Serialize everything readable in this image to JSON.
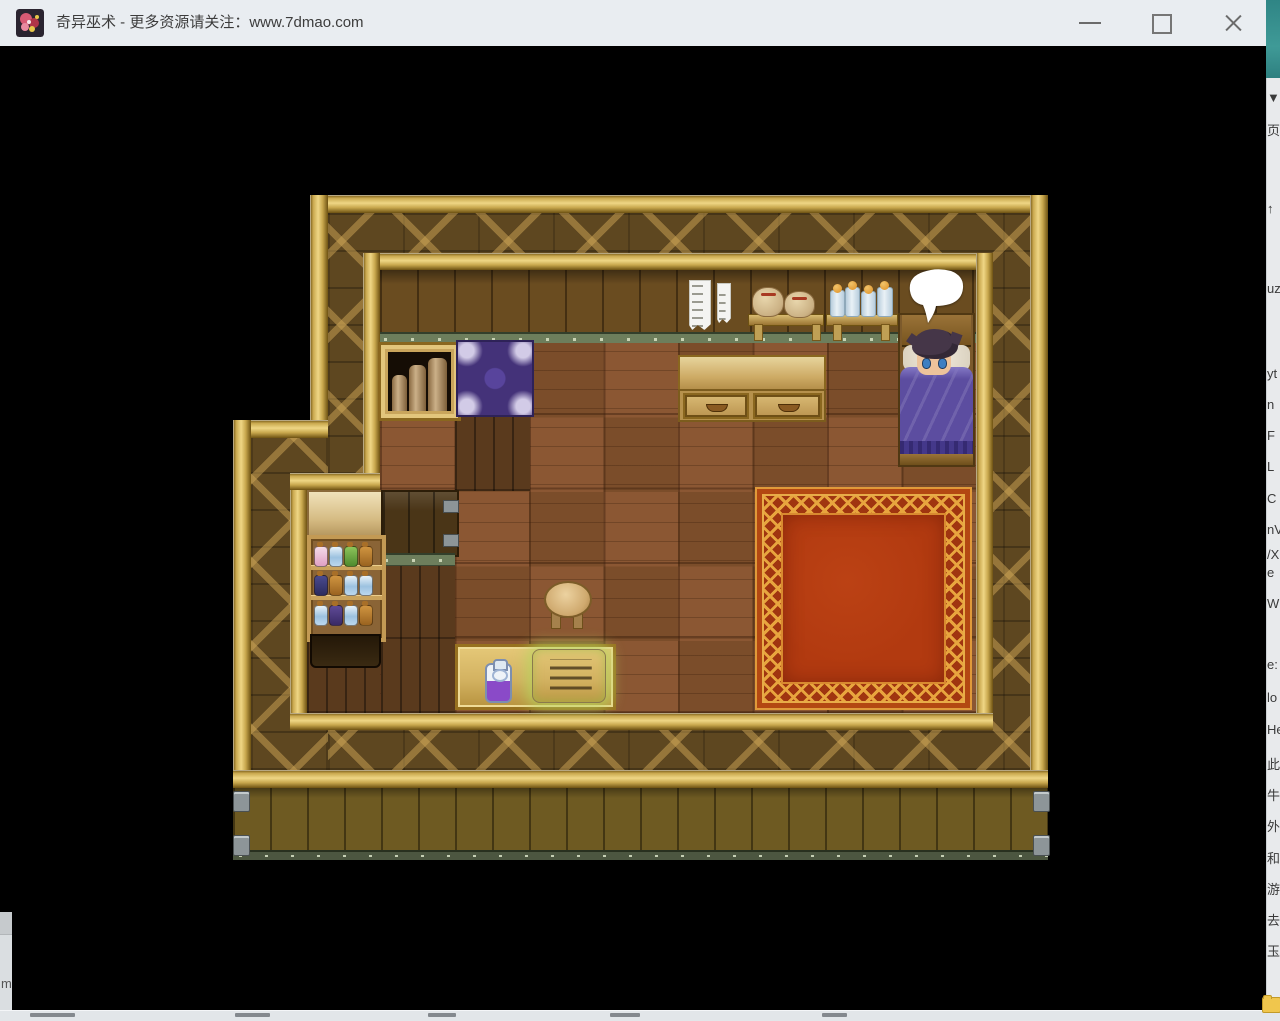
{
  "window": {
    "title": "奇异巫术 - 更多资源请关注：www.7dmao.com",
    "icon": "game-app-icon",
    "controls": {
      "minimize": "minimize",
      "maximize": "maximize",
      "close": "close"
    }
  },
  "game": {
    "scene": "top-down wooden bedroom interior (RPG)",
    "speech_bubble_text": "",
    "objects": [
      "bookshelf with scrolls",
      "purple ornamental rug",
      "hanging paper talismans",
      "wall shelf with sacks",
      "wall shelf with jars",
      "desk with two drawers",
      "bed with sleeping character and purple blanket",
      "empty speech bubble",
      "red ornamental carpet",
      "round stool",
      "potion cabinet with bottles",
      "beige counter",
      "dark wood door panel",
      "table with purple potion and glowing scroll"
    ]
  },
  "desktop": {
    "right_strip": {
      "items": [
        {
          "y": 90,
          "text": "▼"
        },
        {
          "y": 120,
          "text": "页"
        },
        {
          "y": 201,
          "text": "↑"
        },
        {
          "y": 281,
          "text": "uz"
        },
        {
          "y": 366,
          "text": "yt"
        },
        {
          "y": 397,
          "text": "n"
        },
        {
          "y": 428,
          "text": "F"
        },
        {
          "y": 459,
          "text": "L"
        },
        {
          "y": 491,
          "text": "C"
        },
        {
          "y": 522,
          "text": "nV"
        },
        {
          "y": 547,
          "text": "/X"
        },
        {
          "y": 565,
          "text": "e"
        },
        {
          "y": 596,
          "text": "W"
        },
        {
          "y": 657,
          "text": "e:"
        },
        {
          "y": 690,
          "text": "lo"
        },
        {
          "y": 722,
          "text": "He"
        },
        {
          "y": 754,
          "text": "此"
        },
        {
          "y": 785,
          "text": "牛"
        },
        {
          "y": 816,
          "text": "外"
        },
        {
          "y": 848,
          "text": "和"
        },
        {
          "y": 879,
          "text": "游"
        },
        {
          "y": 910,
          "text": "去"
        },
        {
          "y": 941,
          "text": "玉"
        },
        {
          "y": 1000,
          "text": "新建文"
        }
      ]
    },
    "bottom_left_fragment": "m"
  },
  "colors": {
    "titlebar_bg": "#e9edf1",
    "title_text": "#3c3c3c",
    "desktop_teal": "#3a8f8f",
    "side_window_gray": "#e8eaec",
    "frame_gold": "#efd685",
    "lattice_wall": "#5e4720",
    "plank_wall": "#6a4c20",
    "floor_brown": "#8b5733",
    "rail_green": "#6d7e5c",
    "carpet_red": "#b33a10",
    "carpet_gold": "#e8a53e",
    "rug_purple": "#443279",
    "blanket_purple": "#5c4da0",
    "potion_purple": "#8a4ac8",
    "scroll_glow_green": "#b9d878"
  }
}
